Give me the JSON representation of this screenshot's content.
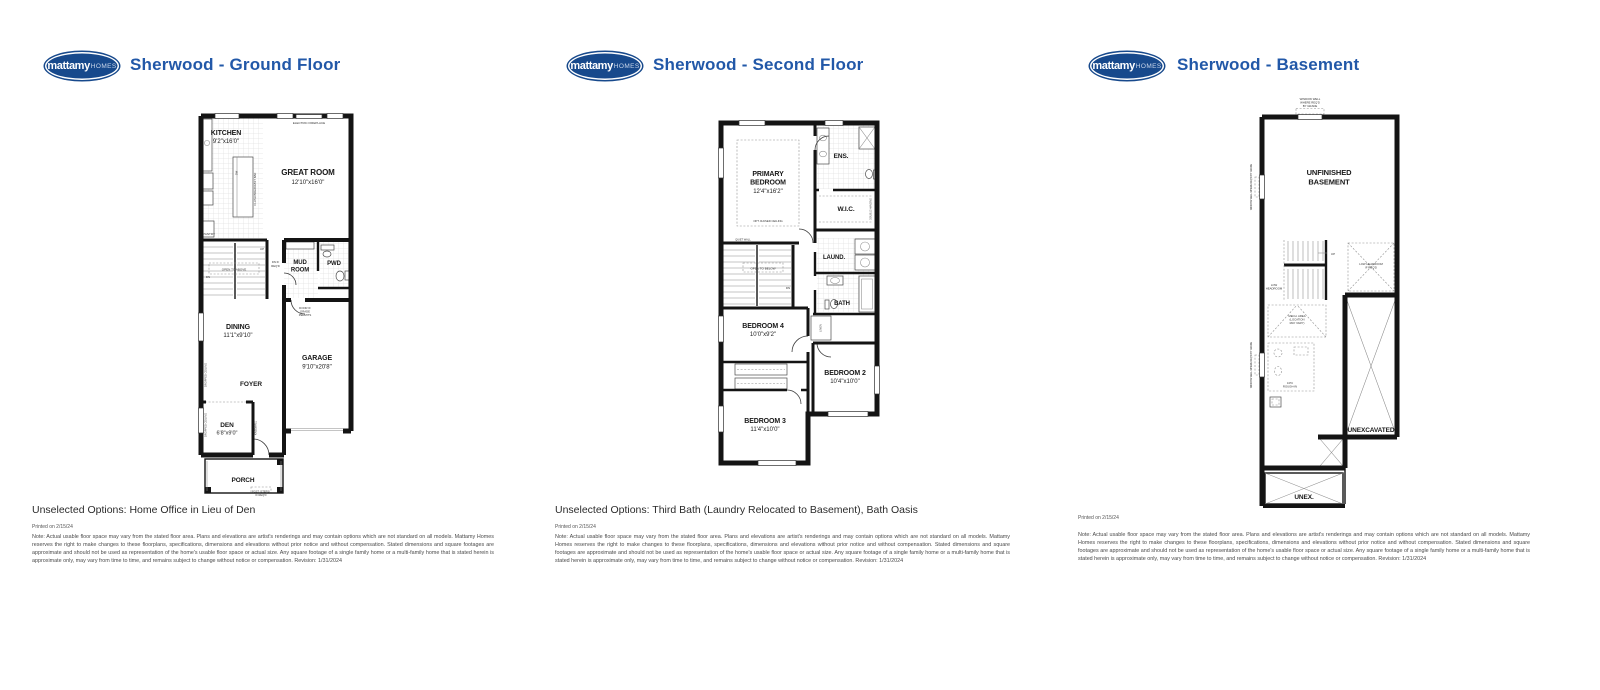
{
  "brand": {
    "logo_main": "mattamy",
    "logo_sub": "HOMES",
    "logo_color": "#17498c",
    "title_color": "#2258a8"
  },
  "footer_note": "Note: Actual usable floor space may vary from the stated floor area. Plans and elevations are artist's renderings and may contain options which are not standard on all models. Mattamy Homes reserves the right to make changes to these floorplans, specifications, dimensions and elevations without prior notice and without compensation. Stated dimensions and square footages are approximate and should not be used as representation of the home's usable floor space or actual size. Any square footage of a single family home or a multi-family home that is stated herein is approximate only, may vary from time to time, and remains subject to change without notice or compensation. Revision: 1/31/2024",
  "panels": {
    "ground": {
      "title": "Sherwood - Ground Floor",
      "footer_options": "Unselected Options: Home Office in Lieu of Den",
      "printed": "Printed on 2/15/24",
      "labels": {
        "kitchen": "KITCHEN",
        "kitchen_dims": "9'2\"x16'0\"",
        "great": "GREAT ROOM",
        "great_dims": "12'10\"x16'0\"",
        "fireplace": "ELECTRIC FIREPLACE",
        "pantry": "PANTRY",
        "breakfast_bar": "FLUSH BREAKFAST BAR",
        "dw": "DW",
        "open_above": "OPEN TO ABOVE",
        "up": "UP",
        "dn": "DN",
        "dn_if_reqd": [
          "DN IF",
          "REQ'D"
        ],
        "mud": [
          "MUD",
          "ROOM"
        ],
        "pwd": "PWD",
        "door_grade": [
          "DOOR IF",
          "GRADE",
          "PERMITS"
        ],
        "dining": "DINING",
        "dining_dims": "11'1\"x9'10\"",
        "garage": "GARAGE",
        "garage_dims": "9'10\"x20'8\"",
        "foyer": "FOYER",
        "den": "DEN",
        "den_dims": "6'8\"x9'0\"",
        "porch": "PORCH",
        "dropped_ceiling": "DROPPED CEILING",
        "kneewall": "KNEEWALL",
        "post_steps": [
          "POST (STEPS)",
          "IF REQ'D"
        ]
      }
    },
    "second": {
      "title": "Sherwood - Second Floor",
      "footer_options": "Unselected Options: Third Bath (Laundry Relocated to Basement), Bath Oasis",
      "printed": "Printed on 2/15/24",
      "labels": {
        "primary": [
          "PRIMARY",
          "BEDROOM"
        ],
        "primary_dims": "12'4\"x16'2\"",
        "opt_ceiling": "OPT. RAISED CEILING",
        "quiet_wall": "QUIET WALL",
        "ens": "ENS.",
        "wic": "W.I.C.",
        "double_hanging": "DOUBLE HANGING",
        "open_below": "OPEN TO BELOW",
        "dn": "DN",
        "laund": "LAUND.",
        "bath": "BATH",
        "linen": "LINEN",
        "bed4": "BEDROOM 4",
        "bed4_dims": "10'0\"x9'2\"",
        "bed2": "BEDROOM 2",
        "bed2_dims": "10'4\"x10'0\"",
        "bed3": "BEDROOM 3",
        "bed3_dims": "11'4\"x10'0\""
      }
    },
    "basement": {
      "title": "Sherwood - Basement",
      "printed": "Printed on 2/15/24",
      "labels": {
        "window_well": [
          "WINDOW WELL",
          "WHERE REQ'D",
          "BY GRADE"
        ],
        "window_well_side": "WINDOW WELL WHERE REQ'D BY GRADE",
        "unfinished": [
          "UNFINISHED",
          "BASEMENT"
        ],
        "up": "UP",
        "low_headroom": [
          "LOW",
          "HEADROOM"
        ],
        "mech": [
          "MECH. AREA",
          "(LOCATION",
          "MAY VARY)"
        ],
        "rough_in": [
          "3-PC",
          "ROUGH-IN"
        ],
        "low_headroom_reqd": [
          "LOW HEADROOM",
          "IF REQ'D"
        ],
        "unexcavated": "UNEXCAVATED",
        "unex": "UNEX."
      }
    }
  }
}
